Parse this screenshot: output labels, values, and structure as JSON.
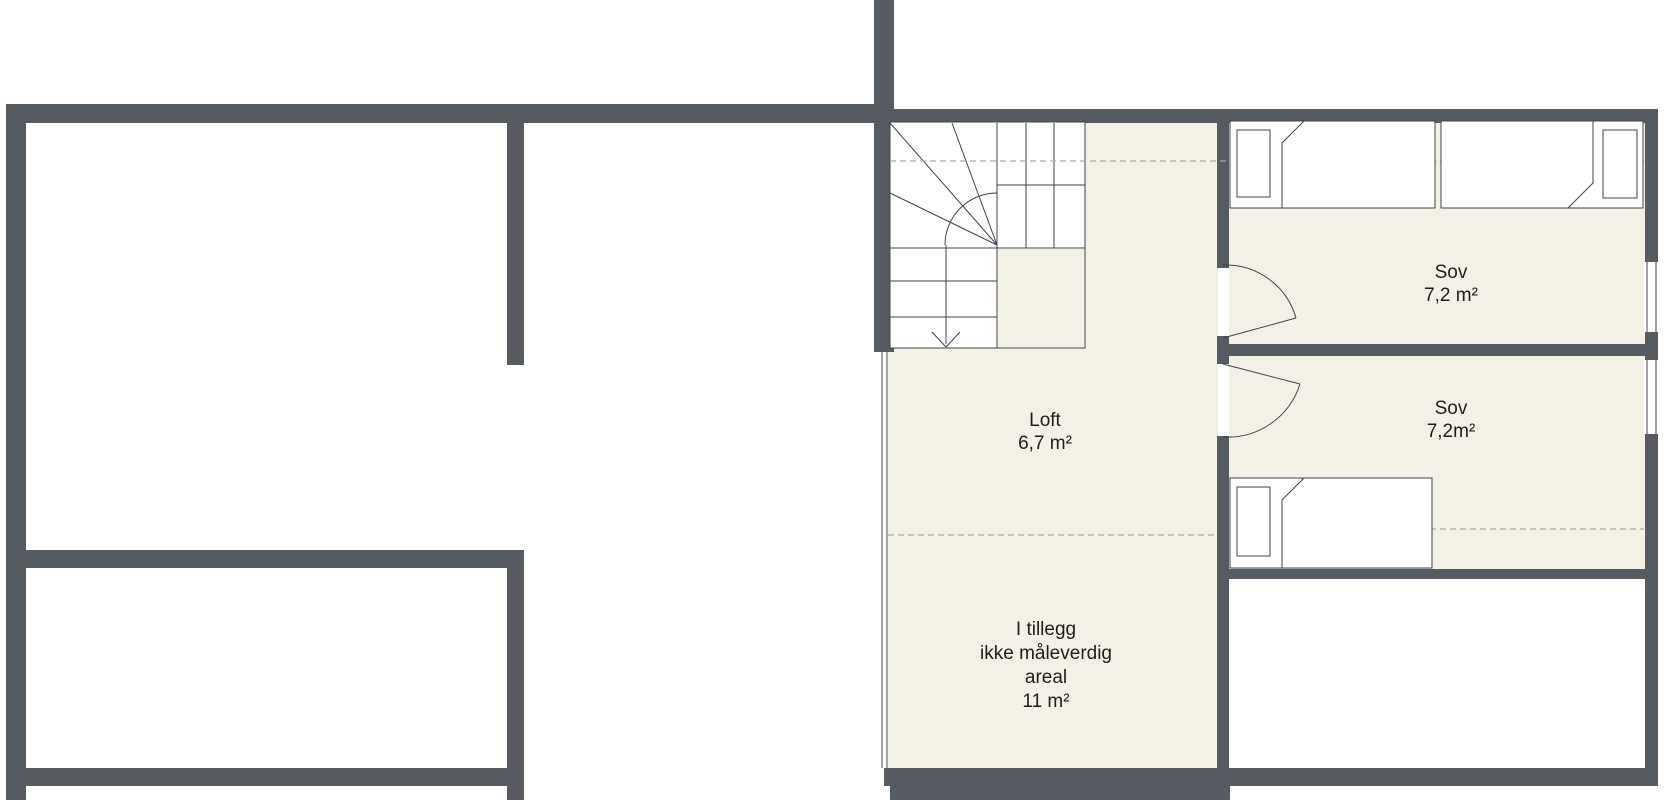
{
  "colors": {
    "wall": "#565B62",
    "floor_shaded": "#F3F0E6",
    "line": "#3F4347",
    "dashed": "#ABABA3",
    "text": "#1D1D1B",
    "bg": "#FFFFFF"
  },
  "plan": {
    "type": "floor-plan",
    "floor": "loft / attic storey",
    "rooms": [
      {
        "name": "Loft",
        "area": "6,7 m²"
      },
      {
        "name": "Sov",
        "area": "7,2 m²"
      },
      {
        "name": "Sov",
        "area": "7,2m²"
      },
      {
        "lines": [
          "I tillegg",
          "ikke måleverdig",
          "areal",
          "11 m²"
        ]
      }
    ],
    "symbols": [
      "staircase-down",
      "door-swing",
      "single-bed",
      "window",
      "ceiling-height-dashed-line"
    ]
  }
}
